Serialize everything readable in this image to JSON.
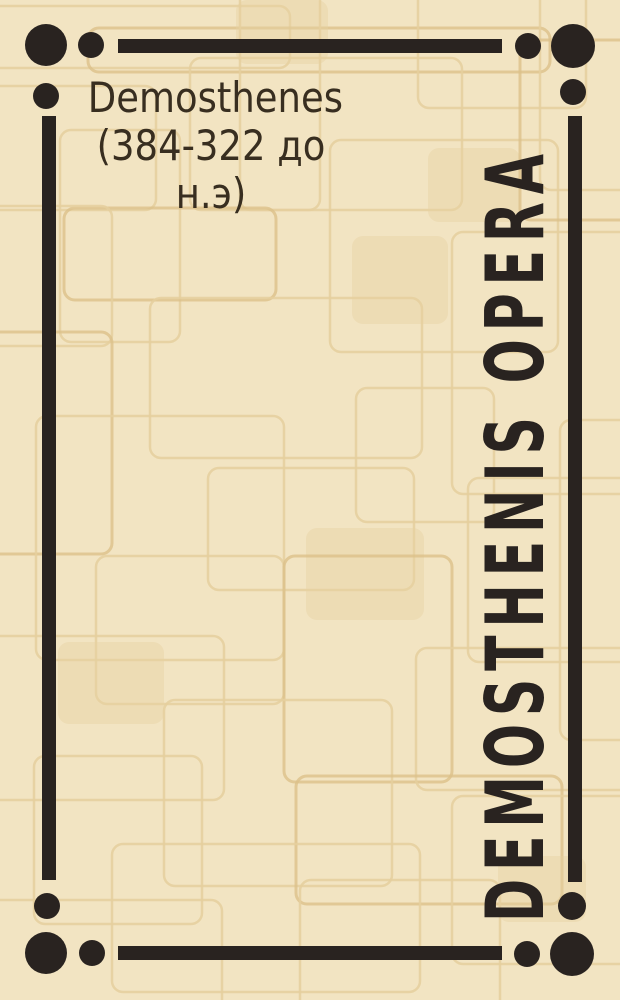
{
  "cover": {
    "author_lines": [
      "Demosthenes",
      "(384-322 до",
      "н.э)"
    ],
    "author_full": "Demosthenes (384-322 до н.э)",
    "spine_title": "DEMOSTHENIS OPERA",
    "colors": {
      "bg": "#f2e4c2",
      "ink": "#292320",
      "text": "#382e20",
      "pattern": "#e5cf9d",
      "pattern_accent": "#dcc189",
      "pattern_fill": "#e7d2a2"
    }
  }
}
